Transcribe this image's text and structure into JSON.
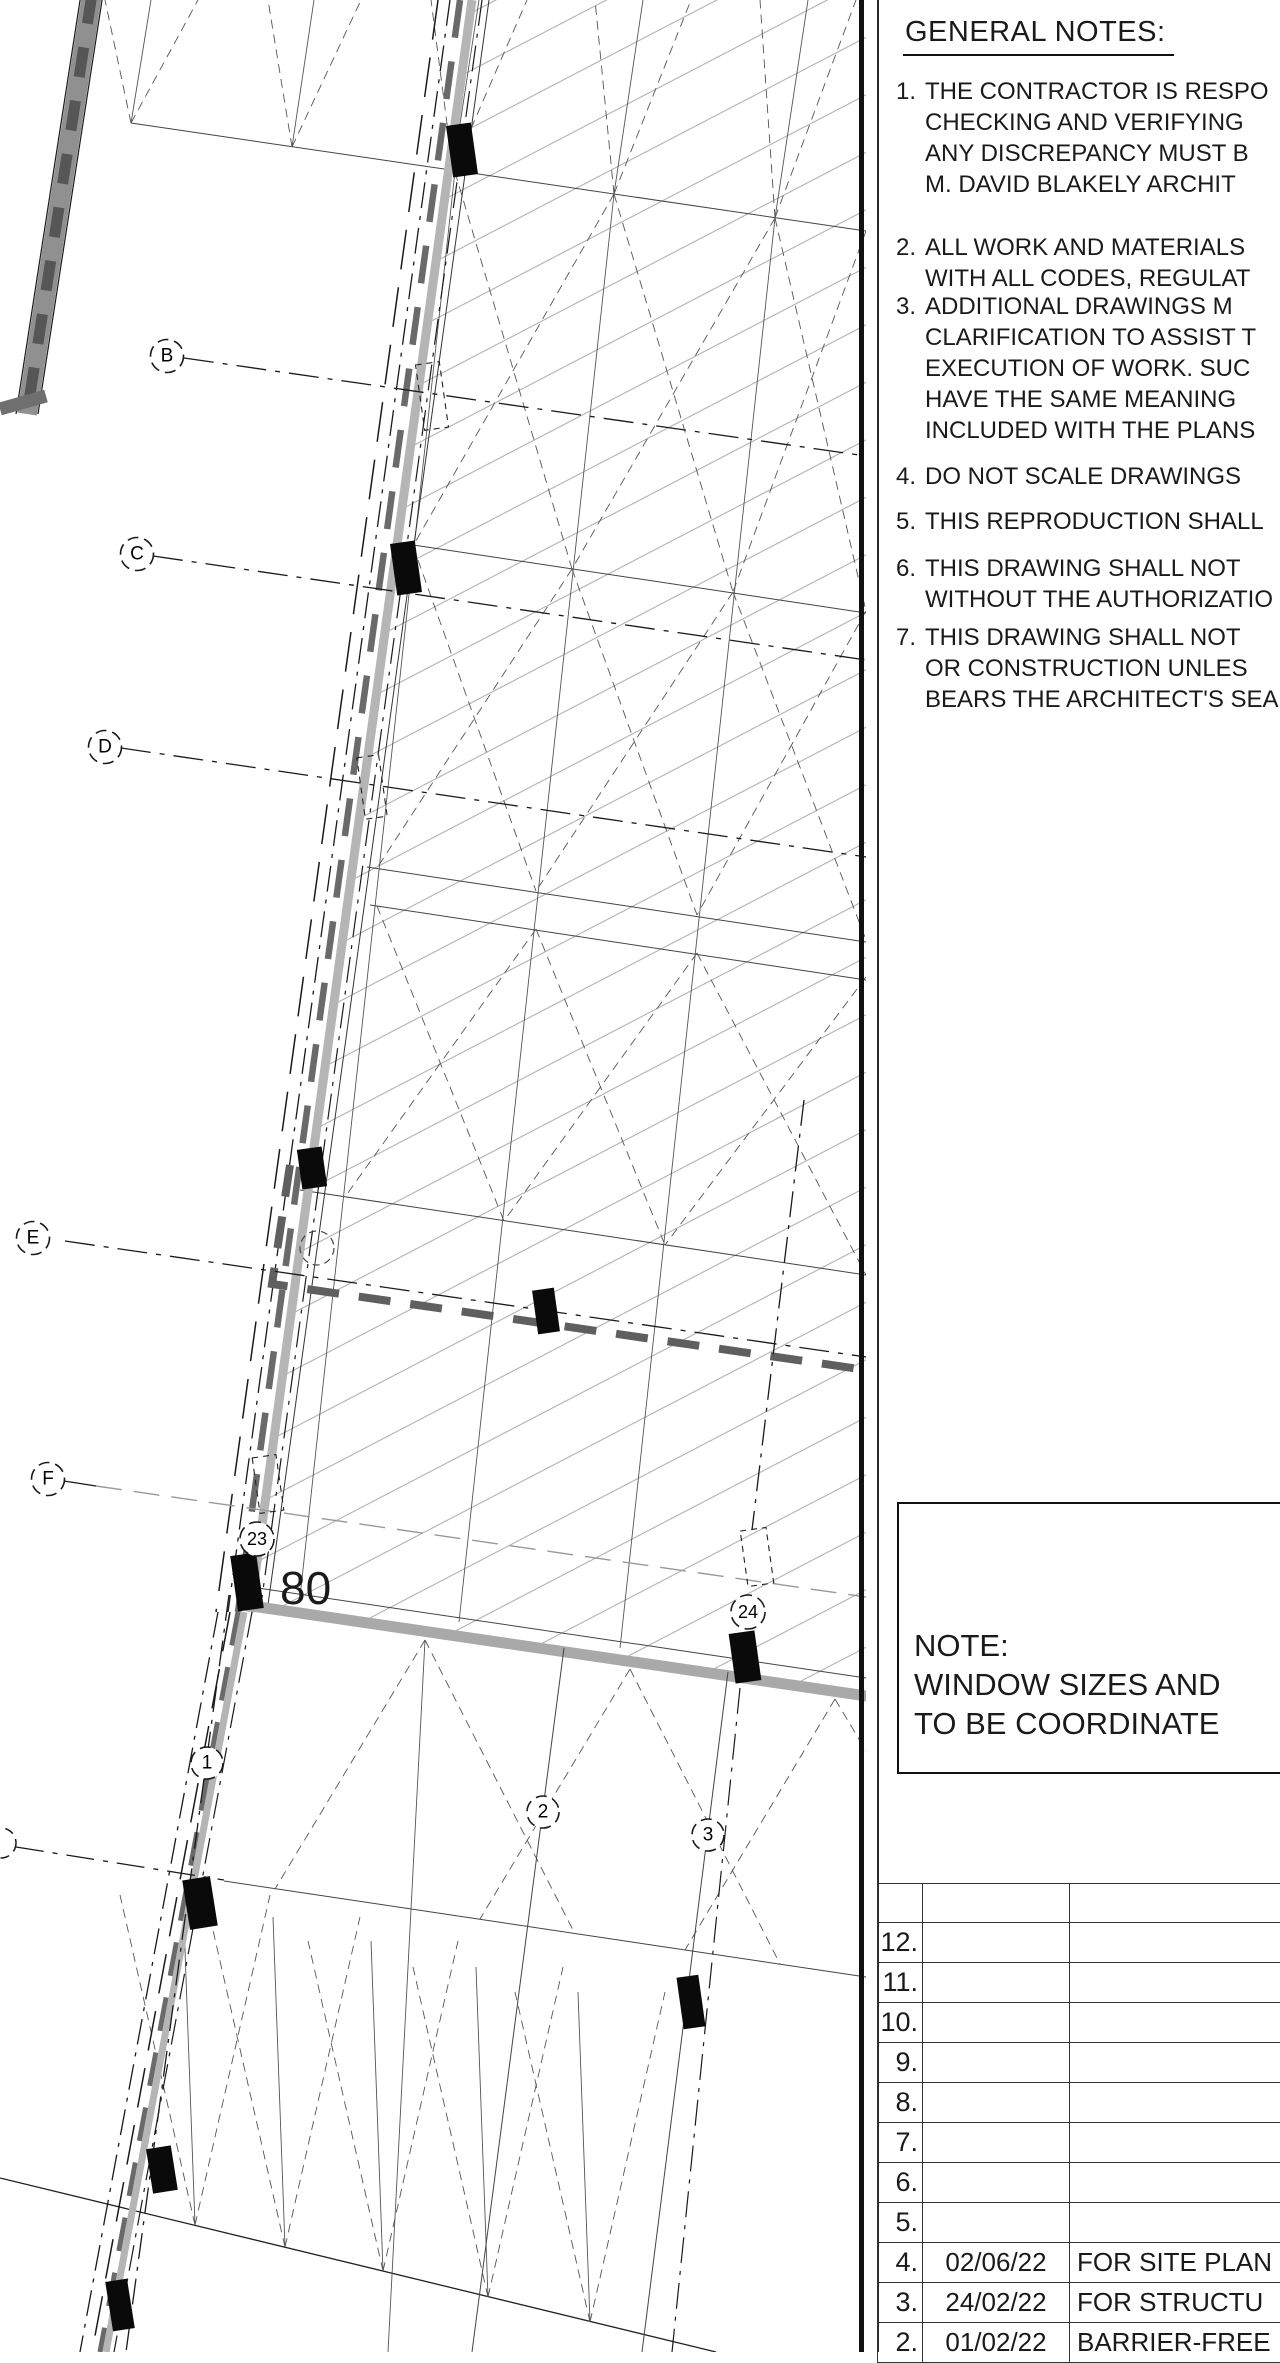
{
  "plan": {
    "bubbles": [
      {
        "label": "B"
      },
      {
        "label": "C"
      },
      {
        "label": "D"
      },
      {
        "label": "E"
      },
      {
        "label": "F"
      },
      {
        "label": "23"
      },
      {
        "label": "24"
      },
      {
        "label": "1"
      },
      {
        "label": "2"
      },
      {
        "label": "3"
      }
    ],
    "dimension_label": "80"
  },
  "notes_panel": {
    "title": "GENERAL NOTES:",
    "notes": [
      {
        "num": "1.",
        "lines": [
          "THE CONTRACTOR IS RESPO",
          "CHECKING AND VERIFYING",
          "ANY DISCREPANCY MUST B",
          "M. DAVID BLAKELY ARCHIT"
        ]
      },
      {
        "num": "2.",
        "lines": [
          "ALL WORK AND MATERIALS",
          "WITH ALL CODES, REGULAT"
        ]
      },
      {
        "num": "3.",
        "lines": [
          "ADDITIONAL DRAWINGS M",
          "CLARIFICATION TO ASSIST T",
          "EXECUTION OF WORK. SUC",
          "HAVE THE SAME MEANING",
          "INCLUDED WITH THE PLANS"
        ]
      },
      {
        "num": "4.",
        "lines": [
          "DO NOT SCALE DRAWINGS"
        ]
      },
      {
        "num": "5.",
        "lines": [
          "THIS REPRODUCTION SHALL"
        ]
      },
      {
        "num": "6.",
        "lines": [
          "THIS DRAWING SHALL NOT",
          "WITHOUT THE AUTHORIZATIO"
        ]
      },
      {
        "num": "7.",
        "lines": [
          "THIS DRAWING SHALL NOT",
          "OR CONSTRUCTION UNLES",
          "BEARS THE ARCHITECT'S SEA"
        ]
      }
    ],
    "note_box": {
      "lines": [
        "NOTE:",
        "WINDOW SIZES AND",
        "TO BE COORDINATE"
      ]
    },
    "revision_table": {
      "rows": [
        {
          "num": "",
          "date": "",
          "desc": ""
        },
        {
          "num": "12.",
          "date": "",
          "desc": ""
        },
        {
          "num": "11.",
          "date": "",
          "desc": ""
        },
        {
          "num": "10.",
          "date": "",
          "desc": ""
        },
        {
          "num": "9.",
          "date": "",
          "desc": ""
        },
        {
          "num": "8.",
          "date": "",
          "desc": ""
        },
        {
          "num": "7.",
          "date": "",
          "desc": ""
        },
        {
          "num": "6.",
          "date": "",
          "desc": ""
        },
        {
          "num": "5.",
          "date": "",
          "desc": ""
        },
        {
          "num": "4.",
          "date": "02/06/22",
          "desc": "FOR SITE PLAN"
        },
        {
          "num": "3.",
          "date": "24/02/22",
          "desc": "FOR STRUCTU"
        },
        {
          "num": "2.",
          "date": "01/02/22",
          "desc": "BARRIER-FREE"
        }
      ]
    }
  },
  "colors": {
    "line": "#1a1a1a",
    "wall_gray": "#b5b5b5",
    "wall_dark_dash": "#5f5f5f",
    "hatch": "#b0b0b0"
  }
}
